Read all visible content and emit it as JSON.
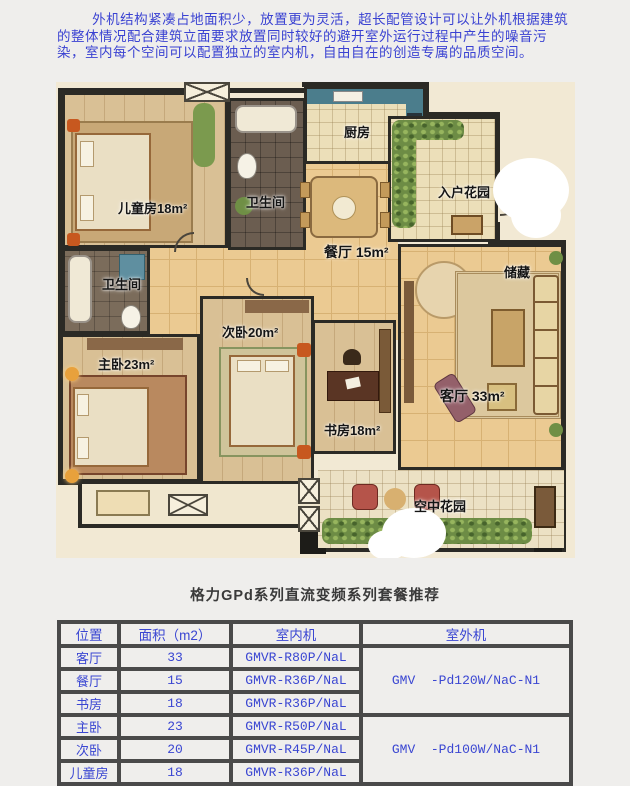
{
  "intro": {
    "text": "外机结构紧凑占地面积少，放置更为灵活，超长配管设计可以让外机根据建筑的整体情况配合建筑立面要求放置同时较好的避开室外运行过程中产生的噪音污染，室内每个空间可以配置独立的室内机，自由自在的创造专属的品质空间。"
  },
  "floorplan": {
    "rooms": {
      "children": "儿童房18m²",
      "bath_top": "卫生间",
      "bath_left": "卫生间",
      "kitchen": "厨房",
      "dining": "餐厅 15m²",
      "entry_garden": "入户花园",
      "storage": "储藏",
      "living": "客厅 33m²",
      "master": "主卧23m²",
      "second": "次卧20m²",
      "study": "书房18m²",
      "sky_garden": "空中花园"
    }
  },
  "section_title": "格力GPd系列直流变频系列套餐推荐",
  "table": {
    "headers": [
      "位置",
      "面积（m2）",
      "室内机",
      "室外机"
    ],
    "rows": [
      {
        "location": "客厅",
        "area": "33",
        "indoor": "GMVR-R80P/NaL"
      },
      {
        "location": "餐厅",
        "area": "15",
        "indoor": "GMVR-R36P/NaL"
      },
      {
        "location": "书房",
        "area": "18",
        "indoor": "GMVR-R36P/NaL"
      },
      {
        "location": "主卧",
        "area": "23",
        "indoor": "GMVR-R50P/NaL"
      },
      {
        "location": "次卧",
        "area": "20",
        "indoor": "GMVR-R45P/NaL"
      },
      {
        "location": "儿童房",
        "area": "18",
        "indoor": "GMVR-R36P/NaL"
      }
    ],
    "outdoor_units": [
      {
        "label": "GMV  -Pd120W/NaC-N1"
      },
      {
        "label": "GMV  -Pd100W/NaC-N1"
      }
    ]
  },
  "colors": {
    "accent_blue": "#3a46d2",
    "page_bg": "#efeeec",
    "plan_cream": "#f2e9d4",
    "wall": "#2b2a25",
    "tile": "#ebca92",
    "kitchen_counter": "#4b7d8c"
  }
}
